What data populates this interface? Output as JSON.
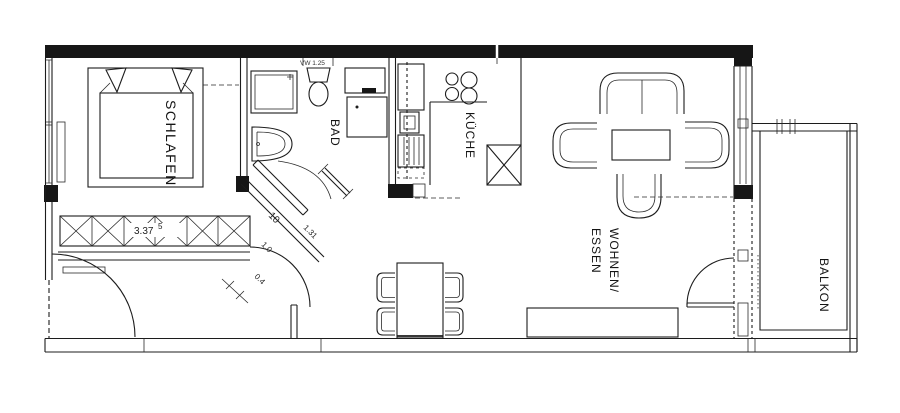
{
  "plan": {
    "colors": {
      "ink": "#1c1c1c",
      "paper": "#ffffff"
    },
    "rooms": {
      "bedroom": "SCHLAFEN",
      "bathroom": "BAD",
      "kitchen": "KÜCHE",
      "living_line1": "WOHNEN/",
      "living_line2": "ESSEN",
      "balcony": "BALKON"
    },
    "dimensions": {
      "wardrobe_length": "3.37",
      "wardrobe_length_sup": "5",
      "bath_vent": "VW 1.25",
      "hall_a": "10",
      "hall_b": "1.31",
      "hall_c": "1.0",
      "hall_d": "0.4"
    }
  }
}
